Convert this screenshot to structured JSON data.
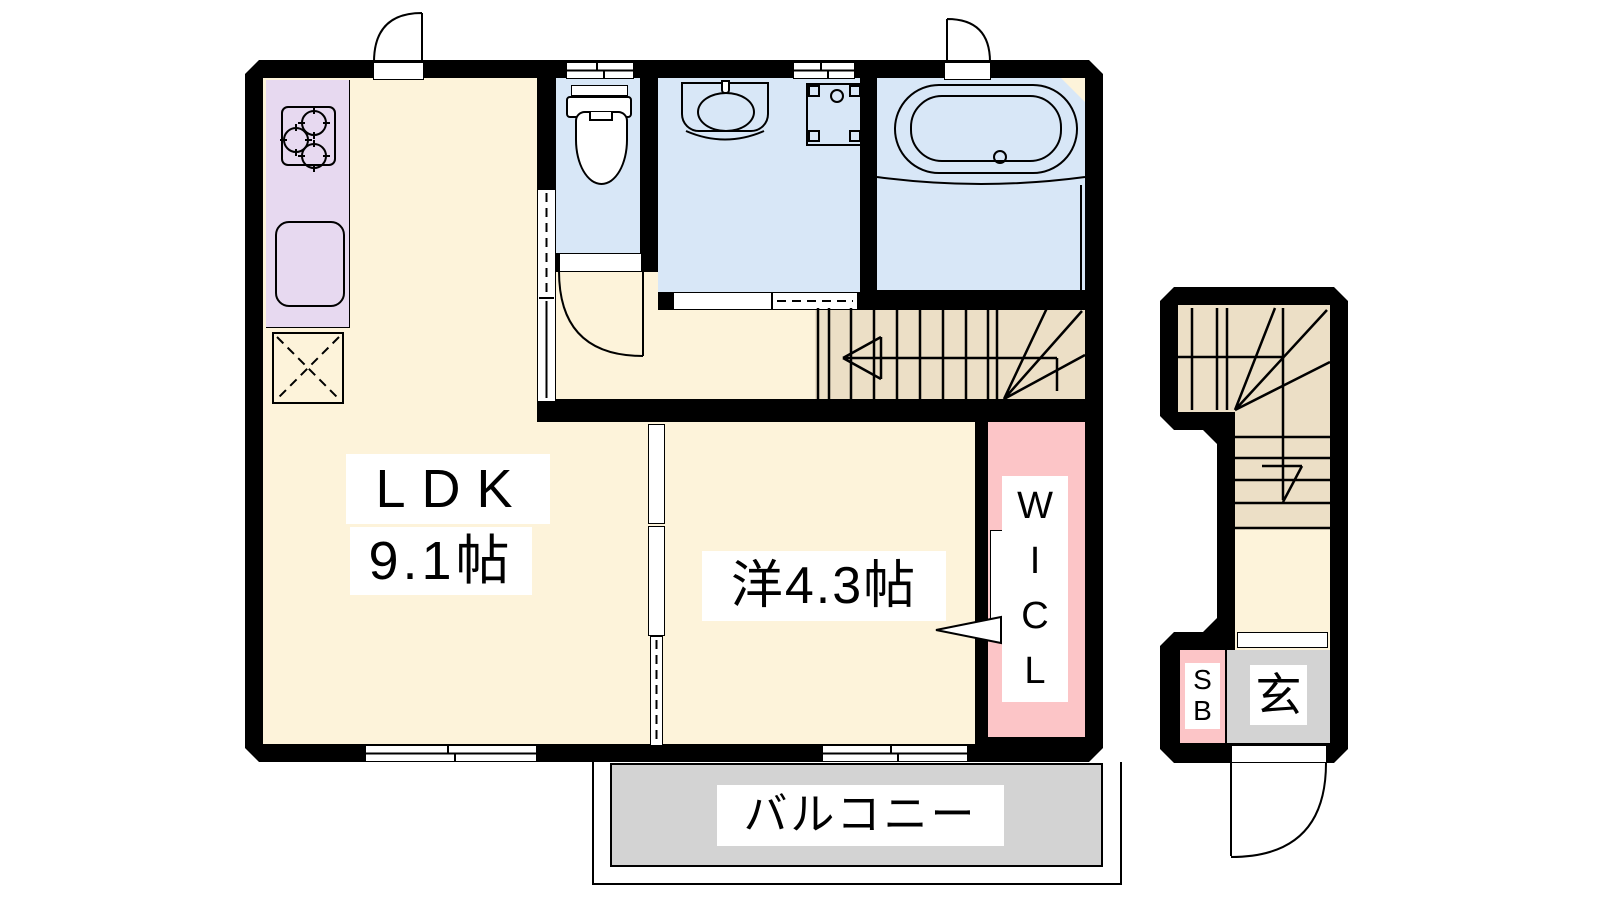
{
  "plan_type": "apartment-floor-plan",
  "palette": {
    "wall": "#000000",
    "floor_cream": "#fdf3da",
    "kitchen_lavender": "#e7d9f0",
    "water_blue": "#d8e7f7",
    "stair_tan": "#ecdfc6",
    "closet_pink": "#fcc5c7",
    "balcony_gray": "#d3d3d3",
    "ink": "#000000"
  },
  "labels": {
    "ldk": "LDK",
    "ldk_size": "9.1帖",
    "western_room": "洋4.3帖",
    "wicl": [
      "W",
      "I",
      "C",
      "L"
    ],
    "balcony": "バルコニー",
    "shoe_box": [
      "S",
      "B"
    ],
    "entrance": "玄"
  },
  "fixtures": [
    "gas-stove-3-burner",
    "kitchen-sink",
    "refrigerator-space",
    "toilet",
    "wash-basin",
    "washing-machine-space",
    "bathtub",
    "main-staircase-with-up-arrow",
    "entrance-staircase-with-up-arrow",
    "sliding-windows",
    "swing-doors",
    "sliding-doors",
    "entrance-step"
  ]
}
